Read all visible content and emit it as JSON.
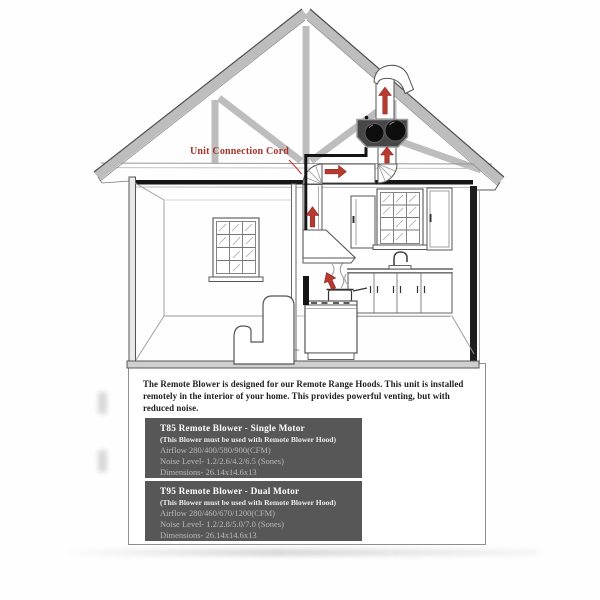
{
  "diagram": {
    "callout": "Unit Connection Cord",
    "description": "The Remote Blower is designed for our Remote Range Hoods.  This unit is installed remotely in the interior of your home.  This provides powerful venting, but with reduced noise."
  },
  "products": [
    {
      "title": "T85 Remote Blower - Single Motor",
      "note": "(This Blower must be used with Remote Blower Hood)",
      "airflow": "Airflow 280/400/580/900(CFM)",
      "noise": "Noise Level- 1.2/2.6/4.2/6.5 (Sones)",
      "dimensions": "Dimensions- 26.14x14.6x13"
    },
    {
      "title": "T95 Remote Blower - Dual Motor",
      "note": "(This Blower must be used with Remote Blower Hood)",
      "airflow": "Airflow 280/460/670/1200(CFM)",
      "noise": "Noise Level- 1.2/2.8/5.0/7.0 (Sones)",
      "dimensions": "Dimensions- 26.14x14.6x13"
    }
  ],
  "colors": {
    "accent_red": "#b8392e",
    "callout_red": "#a83328",
    "spec_box_bg": "#575757",
    "spec_box_title": "#ffffff",
    "spec_box_text": "#b9b9b9",
    "truss_gray": "#bdbdbd"
  }
}
